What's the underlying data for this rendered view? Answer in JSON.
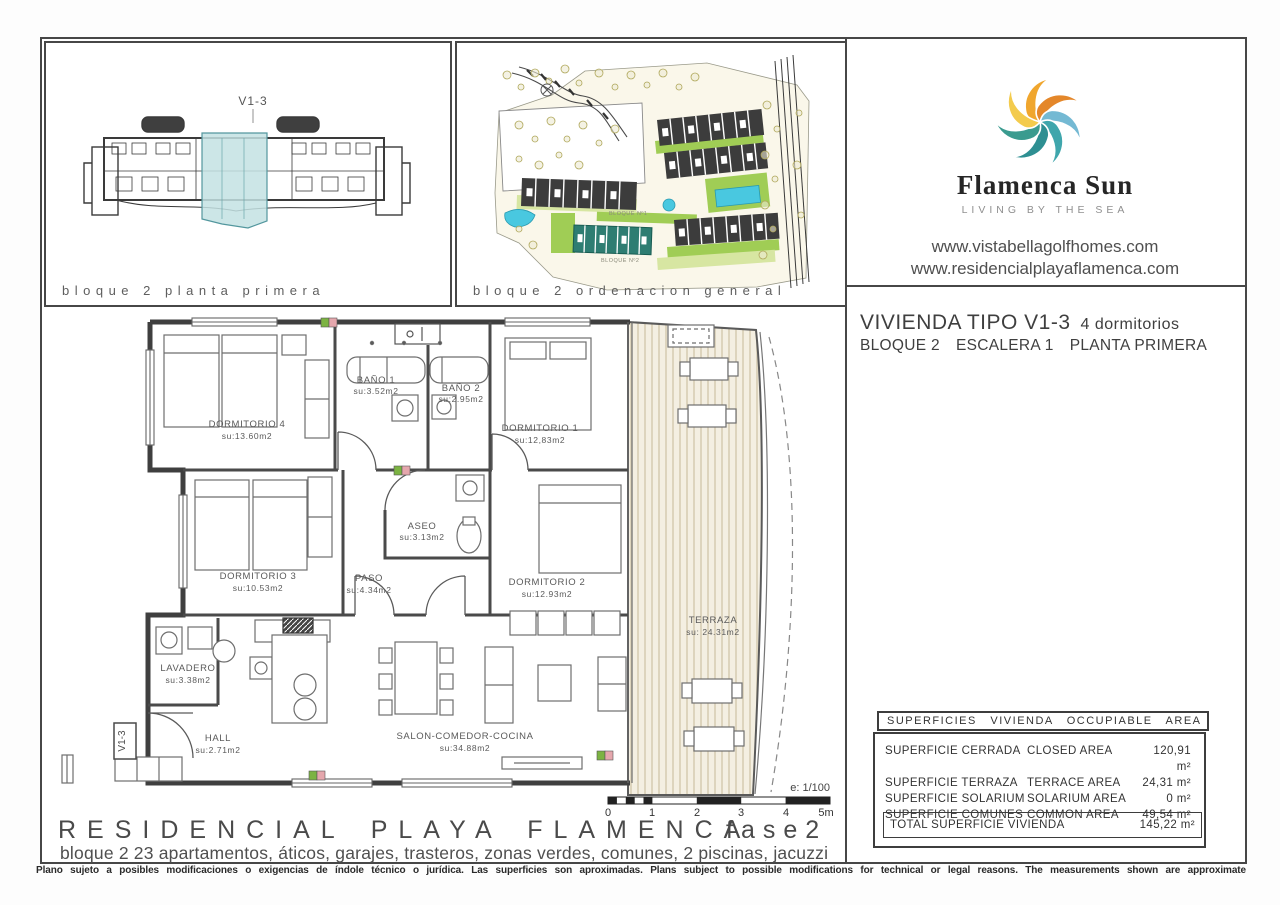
{
  "panels": {
    "block_plan": {
      "caption": "bloque 2 planta primera",
      "unit_label": "V1-3",
      "highlight_color": "#c3e2e3"
    },
    "site_plan": {
      "caption": "bloque 2 ordenacion general",
      "block1_label": "BLOQUE Nº1",
      "block2_label": "BLOQUE Nº2",
      "pool_color": "#49c8e0",
      "green_color": "#9ccb4e"
    }
  },
  "branding": {
    "logo_name": "Flamenca Sun",
    "tagline": "LIVING BY THE SEA",
    "website1": "www.vistabellagolfhomes.com",
    "website2": "www.residencialplayaflamenca.com",
    "logo_colors": [
      "#F0A62E",
      "#E4872A",
      "#74B9D3",
      "#3FA6AC",
      "#2E8F92",
      "#3A9B8F",
      "#F3CB4D"
    ]
  },
  "unit_info": {
    "title": "VIVIENDA TIPO V1-3",
    "bedrooms": "4 dormitorios",
    "block": "BLOQUE 2",
    "staircase": "ESCALERA 1",
    "floor": "PLANTA PRIMERA"
  },
  "floor_plan": {
    "unit_tag": "V1-3",
    "scale_note": "e: 1/100",
    "scale_ticks": [
      "0",
      "1",
      "2",
      "3",
      "4",
      "5m"
    ],
    "rooms": [
      {
        "name": "DORMITORIO 4",
        "area": "su:13.60m2"
      },
      {
        "name": "BAÑO 1",
        "area": "su:3.52m2"
      },
      {
        "name": "BAÑO 2",
        "area": "su:2.95m2"
      },
      {
        "name": "DORMITORIO 1",
        "area": "su:12,83m2"
      },
      {
        "name": "DORMITORIO 3",
        "area": "su:10.53m2"
      },
      {
        "name": "PASO",
        "area": "su:4.34m2"
      },
      {
        "name": "ASEO",
        "area": "su:3.13m2"
      },
      {
        "name": "DORMITORIO 2",
        "area": "su:12.93m2"
      },
      {
        "name": "LAVADERO",
        "area": "su:3.38m2"
      },
      {
        "name": "HALL",
        "area": "su:2.71m2"
      },
      {
        "name": "SALON-COMEDOR-COCINA",
        "area": "su:34.88m2"
      },
      {
        "name": "TERRAZA",
        "area": "su: 24.31m2"
      }
    ]
  },
  "areas_table": {
    "header": "SUPERFICIES VIVIENDA OCCUPIABLE AREA",
    "rows": [
      {
        "es": "SUPERFICIE CERRADA",
        "en": "CLOSED AREA",
        "value": "120,91 m²"
      },
      {
        "es": "SUPERFICIE TERRAZA",
        "en": "TERRACE AREA",
        "value": "24,31 m²"
      },
      {
        "es": "SUPERFICIE SOLARIUM",
        "en": "SOLARIUM AREA",
        "value": "0 m²"
      },
      {
        "es": "SUPERFICIE COMUNES",
        "en": "COMMON AREA",
        "value": "49,54 m²"
      }
    ],
    "total_label": "TOTAL SUPERFICIE VIVIENDA",
    "total_value": "145,22 m²"
  },
  "footer": {
    "project": "RESIDENCIAL PLAYA FLAMENCA",
    "phase": "fase2",
    "description": "bloque 2   23 apartamentos, áticos, garajes, trasteros, zonas verdes, comunes, 2 piscinas, jacuzzi",
    "disclaimer": "Plano sujeto a posibles modificaciones o exigencias de índole técnico o jurídica. Las superficies son aproximadas. Plans subject to possible modifications for technical or legal reasons. The measurements shown are approximate"
  }
}
